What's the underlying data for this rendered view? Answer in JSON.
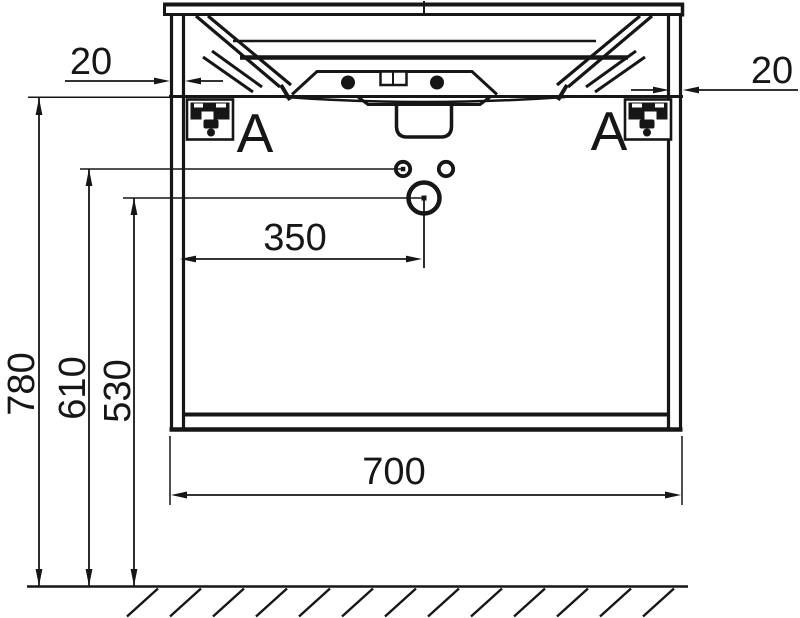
{
  "page": {
    "background": "#ffffff"
  },
  "drawing": {
    "stroke_color": "#161616",
    "dimensions": {
      "overall_height": "780",
      "upper_holes_height": "610",
      "drain_hole_height": "530",
      "cabinet_width": "700",
      "drain_offset_from_side": "350",
      "panel_thickness_left": "20",
      "panel_thickness_right": "20"
    },
    "section_labels": {
      "left": "A",
      "right": "A"
    }
  }
}
